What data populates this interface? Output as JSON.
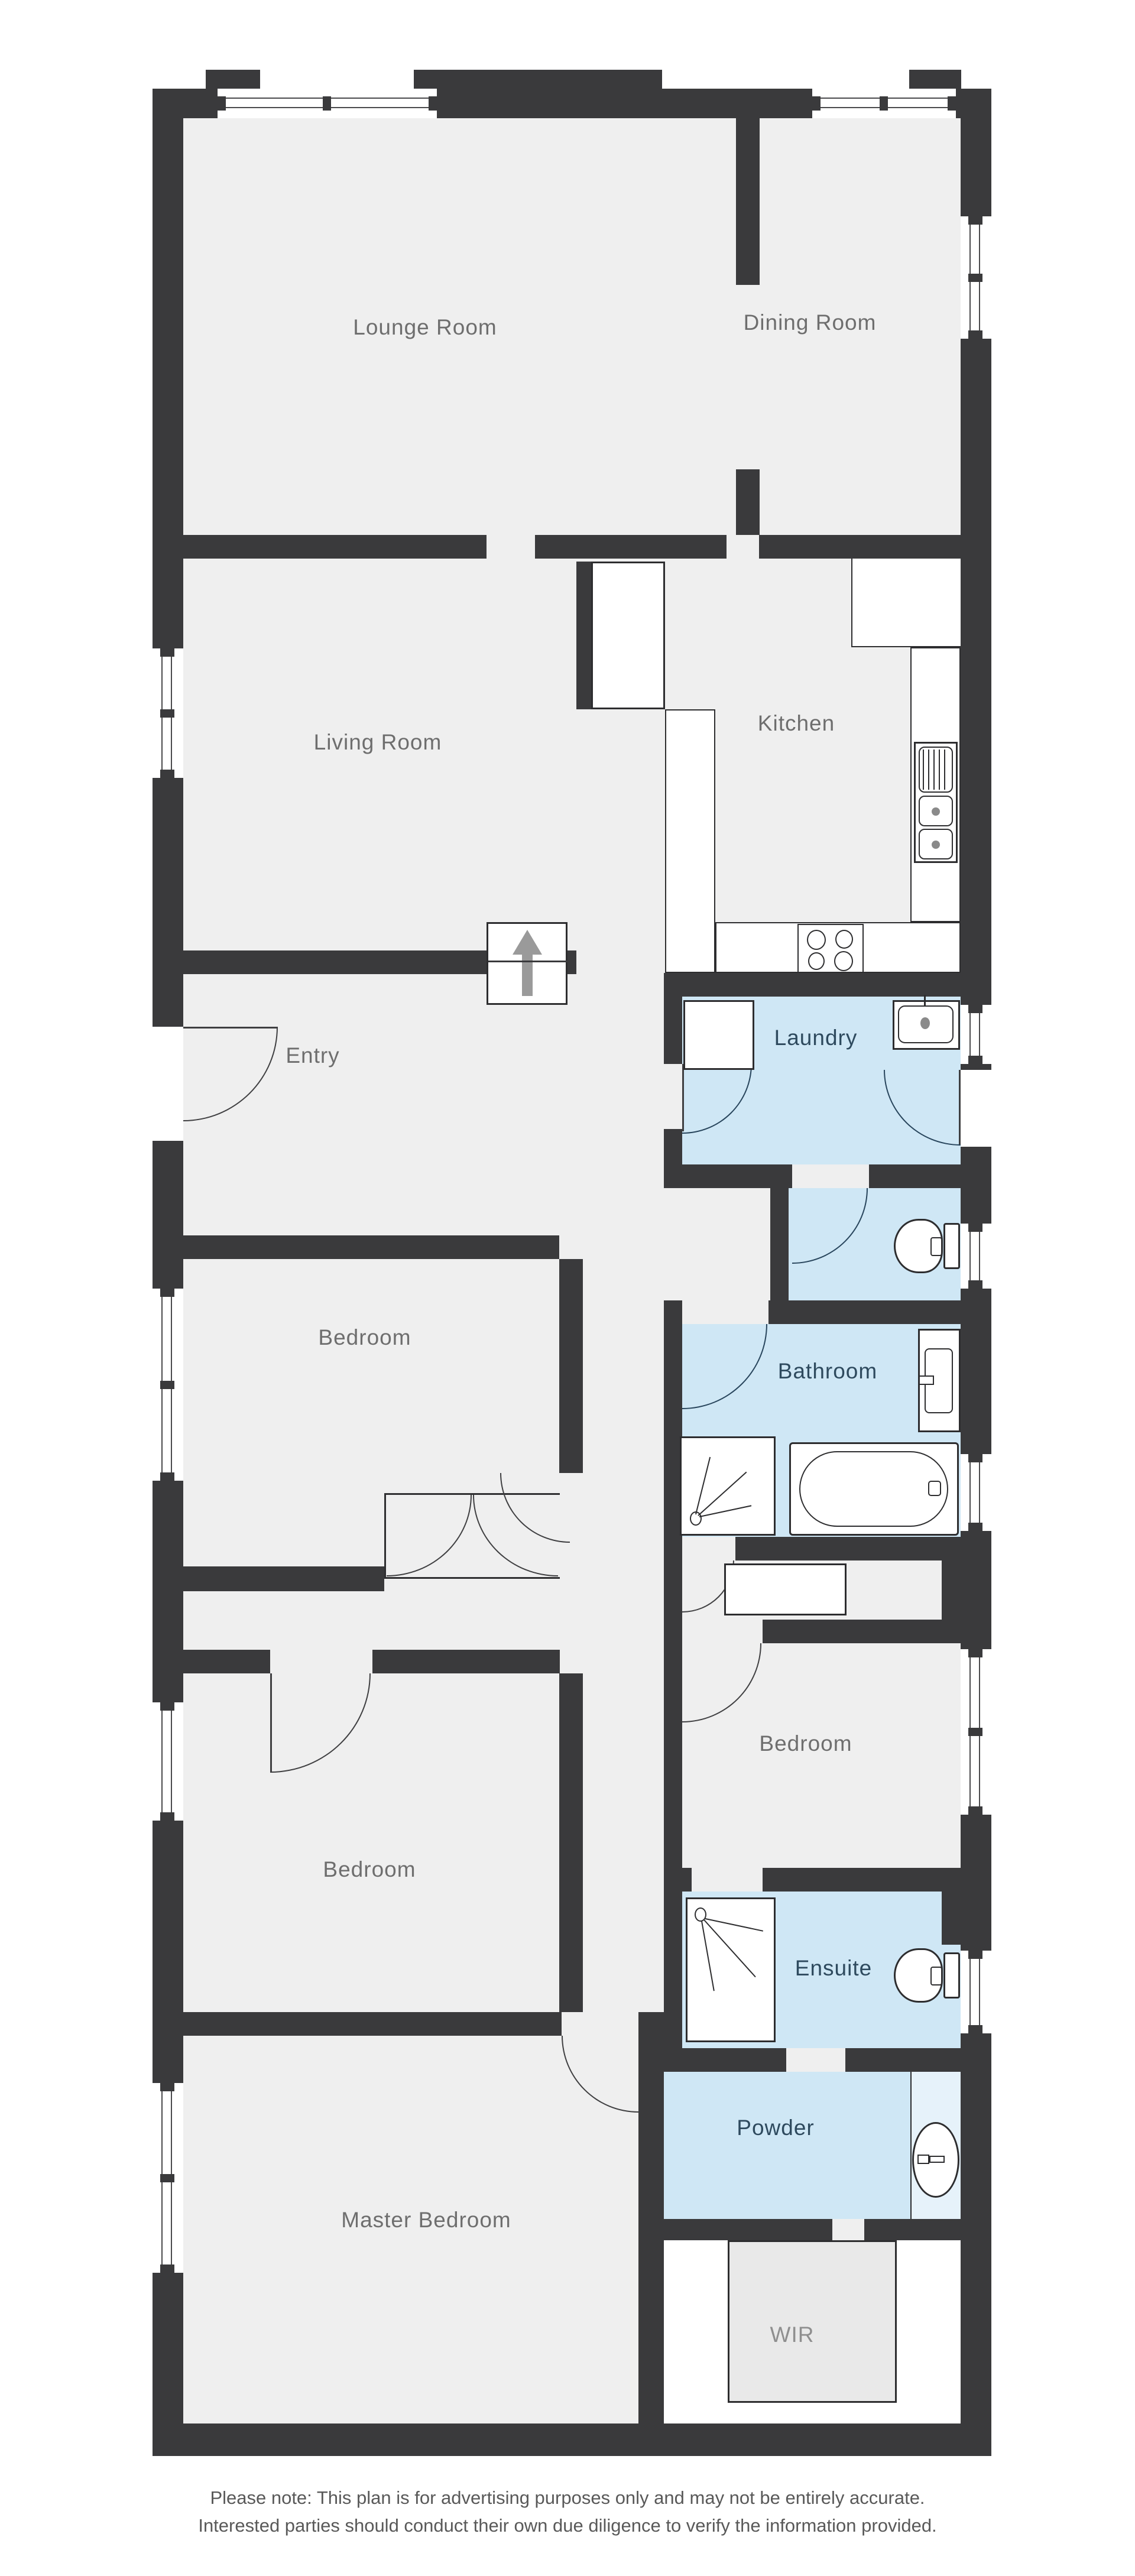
{
  "plan": {
    "title": "Residential floor plan",
    "rooms": {
      "lounge": {
        "label": "Lounge Room"
      },
      "dining": {
        "label": "Dining Room"
      },
      "living": {
        "label": "Living Room"
      },
      "kitchen": {
        "label": "Kitchen"
      },
      "entry": {
        "label": "Entry"
      },
      "laundry": {
        "label": "Laundry"
      },
      "bedroom1": {
        "label": "Bedroom"
      },
      "bathroom": {
        "label": "Bathroom"
      },
      "bedroom2": {
        "label": "Bedroom"
      },
      "bedroom3": {
        "label": "Bedroom"
      },
      "ensuite": {
        "label": "Ensuite"
      },
      "powder": {
        "label": "Powder"
      },
      "master": {
        "label": "Master Bedroom"
      },
      "wir": {
        "label": "WIR"
      }
    },
    "fixtures": [
      "entry-arrow",
      "pantry",
      "fridge-space",
      "kitchen-sink",
      "cooktop",
      "laundry-cupboard",
      "laundry-tub",
      "toilet",
      "vanity",
      "shower",
      "bath",
      "linen-robe",
      "ensuite-shower",
      "ensuite-toilet",
      "powder-basin",
      "wir-robe"
    ],
    "colors": {
      "wall": "#3a3a3c",
      "floor": "#efefef",
      "wet_floor": "#cfe7f5",
      "wet_floor_light": "#e6f2fa",
      "door_arc_wet": "#28455c",
      "door_arc_dry": "#3f3f41",
      "label": "#6e6e6e",
      "label_wet": "#2e4a5e"
    },
    "disclaimer": {
      "line1": "Please note: This plan is for advertising purposes only and may not be entirely accurate.",
      "line2": "Interested parties should conduct their own due diligence to verify the information provided."
    }
  }
}
